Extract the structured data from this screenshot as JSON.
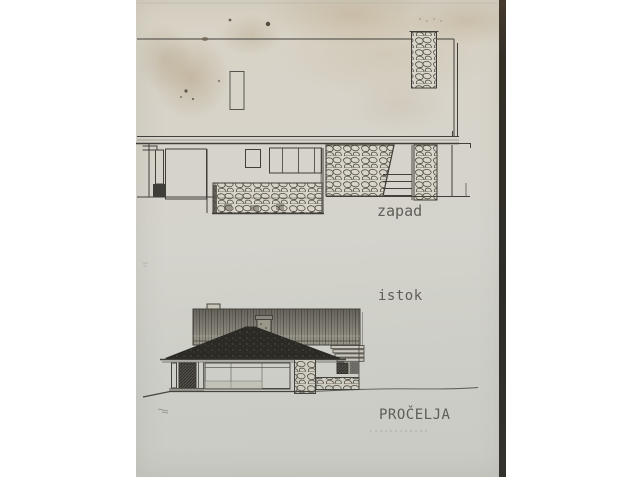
{
  "sheet": {
    "labels": {
      "west_elevation": "zapad",
      "east_elevation": "istok",
      "title": "PROČELJA"
    },
    "colors": {
      "paper": "#d4d2c9",
      "stain_brown": "#a98f68",
      "ink": "#413f39",
      "roof_fill": "#2c2a25",
      "sheet_edge": "#312f2a",
      "background": "#ffffff"
    },
    "drawings": [
      {
        "id": "west-elevation",
        "label": "zapad"
      },
      {
        "id": "east-elevation",
        "label": "istok"
      }
    ]
  }
}
